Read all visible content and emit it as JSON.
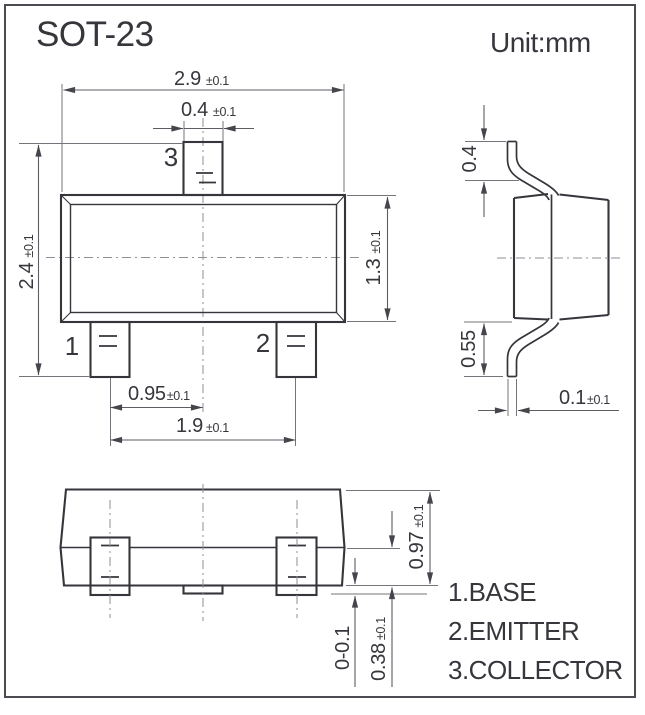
{
  "title": "SOT-23",
  "unit_label": "Unit:mm",
  "front_view": {
    "pin1": "1",
    "pin2": "2",
    "pin3": "3",
    "dims": {
      "body_width": {
        "v": "2.9",
        "t": "±0.1"
      },
      "tab_width": {
        "v": "0.4",
        "t": "±0.1"
      },
      "total_height": {
        "v": "2.4",
        "t": "±0.1"
      },
      "body_height": {
        "v": "1.3",
        "t": "±0.1"
      },
      "lead_pitch": {
        "v": "0.95",
        "t": "±0.1"
      },
      "lead_span": {
        "v": "1.9",
        "t": "±0.1"
      }
    }
  },
  "side_view": {
    "dims": {
      "lead_top_height": {
        "v": "0.4"
      },
      "lead_bottom_height": {
        "v": "0.55"
      },
      "lead_thickness": {
        "v": "0.1",
        "t": "±0.1"
      }
    }
  },
  "bottom_view": {
    "dims": {
      "overall_height": {
        "v": "0.97",
        "t": "±0.1"
      },
      "standoff": {
        "v": "0-0.1"
      },
      "lead_width": {
        "v": "0.38",
        "t": "±0.1"
      }
    }
  },
  "legend": {
    "pin1": "1.BASE",
    "pin2": "2.EMITTER",
    "pin3": "3.COLLECTOR"
  }
}
